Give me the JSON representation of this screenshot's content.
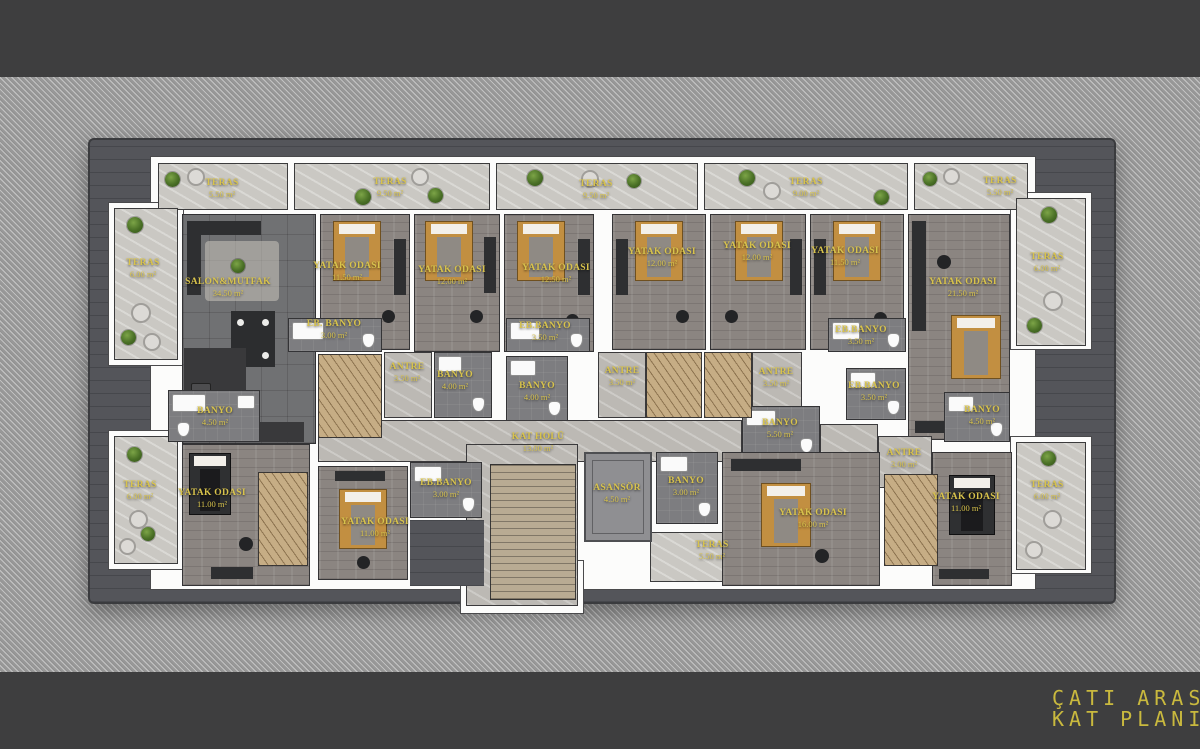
{
  "title": {
    "line1": "ÇATI ARASI",
    "line2": "KAT PLANI"
  },
  "plan_name": "Çatı Arası Kat Planı",
  "area_unit": "m²",
  "colors": {
    "accent_yellow": "#C9B93E",
    "label_yellow": "#D8C34C",
    "band_dark": "#3E3E3F",
    "hatch_background": "#989898",
    "deck_gray": "#54555A",
    "wall_white": "#FCFCFB",
    "wood_floor": "#8B8581",
    "marble_floor": "#CAC8C3",
    "bed_tan": "#C28F41"
  },
  "labels": [
    {
      "n": "TERAS",
      "a": "5.50 m²"
    },
    {
      "n": "TERAS",
      "a": "9.50 m²"
    },
    {
      "n": "TERAS",
      "a": "9.50 m²"
    },
    {
      "n": "TERAS",
      "a": "9.00 m²"
    },
    {
      "n": "TERAS",
      "a": "5.50 m²"
    },
    {
      "n": "TERAS",
      "a": "6.00 m²"
    },
    {
      "n": "TERAS",
      "a": "6.00 m²"
    },
    {
      "n": "TERAS",
      "a": "6.00 m²"
    },
    {
      "n": "TERAS",
      "a": "6.00 m²"
    },
    {
      "n": "TERAS",
      "a": "5.50 m²"
    },
    {
      "n": "SALON&MUTFAK",
      "a": "34.50 m²"
    },
    {
      "n": "YATAK ODASI",
      "a": "11.50 m²"
    },
    {
      "n": "YATAK ODASI",
      "a": "12.00 m²"
    },
    {
      "n": "YATAK ODASI",
      "a": "12.50 m²"
    },
    {
      "n": "YATAK ODASI",
      "a": "12.00 m²"
    },
    {
      "n": "YATAK ODASI",
      "a": "12.00 m²"
    },
    {
      "n": "YATAK ODASI",
      "a": "11.50 m²"
    },
    {
      "n": "YATAK ODASI",
      "a": "21.50 m²"
    },
    {
      "n": "EB. BANYO",
      "a": "3.00 m²"
    },
    {
      "n": "EB.BANYO",
      "a": "3.50 m²"
    },
    {
      "n": "EB.BANYO",
      "a": "3.50 m²"
    },
    {
      "n": "EB.BANYO",
      "a": "3.50 m²"
    },
    {
      "n": "ANTRE",
      "a": "3.50 m²"
    },
    {
      "n": "BANYO",
      "a": "4.00 m²"
    },
    {
      "n": "BANYO",
      "a": "4.00 m²"
    },
    {
      "n": "ANTRE",
      "a": "3.50 m²"
    },
    {
      "n": "ANTRE",
      "a": "3.50 m²"
    },
    {
      "n": "BANYO",
      "a": "5.50 m²"
    },
    {
      "n": "BANYO",
      "a": "4.50 m²"
    },
    {
      "n": "BANYO",
      "a": "4.50 m²"
    },
    {
      "n": "EB.BANYO",
      "a": "3.00 m²"
    },
    {
      "n": "BANYO",
      "a": "3.00 m²"
    },
    {
      "n": "ANTRE",
      "a": "3.00 m²"
    },
    {
      "n": "KAT HOLÜ",
      "a": "13.00 m²"
    },
    {
      "n": "ASANSÖR",
      "a": "4.50 m²"
    },
    {
      "n": "YATAK ODASI",
      "a": "11.00 m²"
    },
    {
      "n": "YATAK ODASI",
      "a": "11.00 m²"
    },
    {
      "n": "YATAK ODASI",
      "a": "16.00 m²"
    },
    {
      "n": "YATAK ODASI",
      "a": "11.00 m²"
    }
  ]
}
